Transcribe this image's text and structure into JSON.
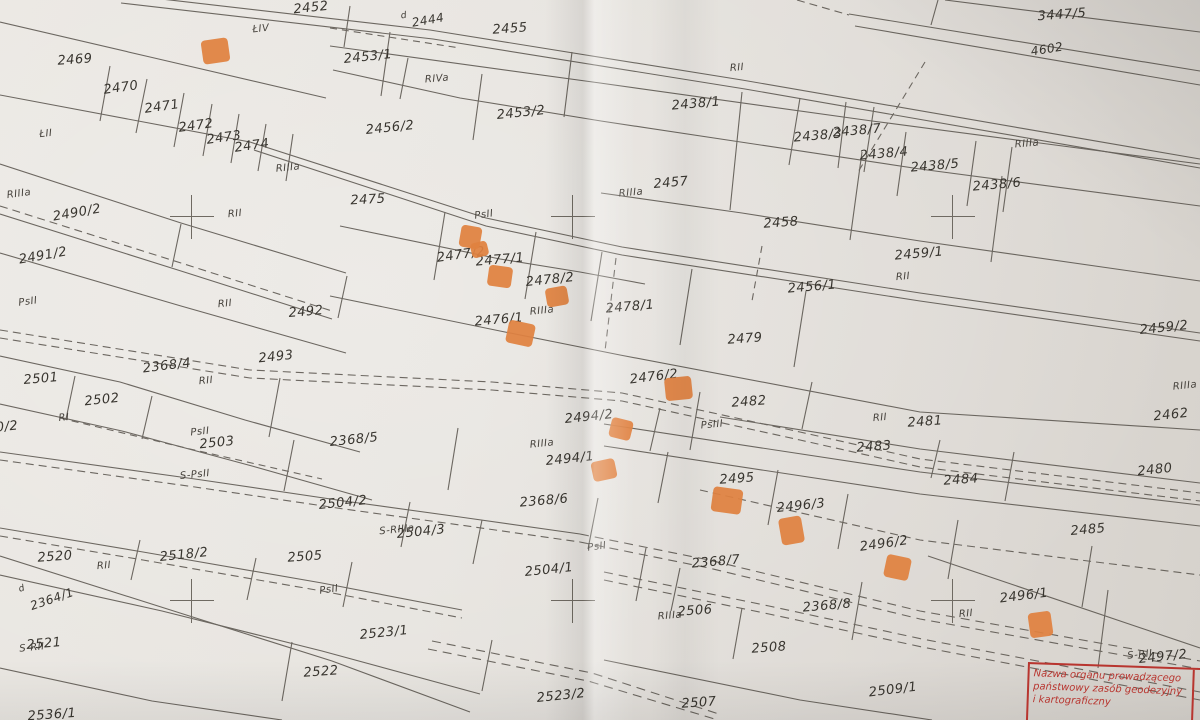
{
  "map": {
    "description": "cadastral parcel map sheet (photograph)",
    "paper_color": "#e6e3de",
    "line_color": "#5b564f",
    "marker_color": "#e0813f",
    "stamp": {
      "color": "#b8352f",
      "lines": [
        "Nazwa organu prowadzącego",
        "państwowy zasób geodezyjny",
        "i kartograficzny"
      ],
      "side_letter": "S"
    },
    "labels": [
      {
        "t": "2455",
        "x": 510,
        "y": 29,
        "r": -4,
        "k": "p"
      },
      {
        "t": "2452",
        "x": 311,
        "y": 8,
        "r": -6,
        "k": "p"
      },
      {
        "t": "2469",
        "x": 75,
        "y": 60,
        "r": -4,
        "k": "p"
      },
      {
        "t": "2470",
        "x": 121,
        "y": 88,
        "r": -8,
        "k": "p"
      },
      {
        "t": "2471",
        "x": 162,
        "y": 107,
        "r": -8,
        "k": "p"
      },
      {
        "t": "2472",
        "x": 196,
        "y": 126,
        "r": -8,
        "k": "p"
      },
      {
        "t": "2473",
        "x": 224,
        "y": 138,
        "r": -8,
        "k": "p"
      },
      {
        "t": "2474",
        "x": 252,
        "y": 146,
        "r": -8,
        "k": "p"
      },
      {
        "t": "2453/1",
        "x": 368,
        "y": 57,
        "r": -6,
        "k": "p"
      },
      {
        "t": "2453/2",
        "x": 521,
        "y": 113,
        "r": -6,
        "k": "p"
      },
      {
        "t": "2456/2",
        "x": 390,
        "y": 128,
        "r": -6,
        "k": "p"
      },
      {
        "t": "2438/1",
        "x": 696,
        "y": 104,
        "r": -5,
        "k": "p"
      },
      {
        "t": "2438/3",
        "x": 818,
        "y": 136,
        "r": -5,
        "k": "p"
      },
      {
        "t": "2438/7",
        "x": 857,
        "y": 131,
        "r": -5,
        "k": "p"
      },
      {
        "t": "2438/4",
        "x": 884,
        "y": 154,
        "r": -5,
        "k": "p"
      },
      {
        "t": "2438/5",
        "x": 935,
        "y": 166,
        "r": -5,
        "k": "p"
      },
      {
        "t": "2438/6",
        "x": 997,
        "y": 185,
        "r": -5,
        "k": "p"
      },
      {
        "t": "3447/5",
        "x": 1062,
        "y": 15,
        "r": -4,
        "k": "p"
      },
      {
        "t": "2457",
        "x": 671,
        "y": 183,
        "r": -5,
        "k": "p"
      },
      {
        "t": "2458",
        "x": 781,
        "y": 223,
        "r": -4,
        "k": "p"
      },
      {
        "t": "2456/1",
        "x": 812,
        "y": 287,
        "r": -5,
        "k": "p"
      },
      {
        "t": "2459/1",
        "x": 919,
        "y": 254,
        "r": -5,
        "k": "p"
      },
      {
        "t": "2459/2",
        "x": 1164,
        "y": 328,
        "r": -6,
        "k": "p"
      },
      {
        "t": "2475",
        "x": 368,
        "y": 200,
        "r": -3,
        "k": "p"
      },
      {
        "t": "2477/2",
        "x": 461,
        "y": 255,
        "r": -8,
        "k": "p"
      },
      {
        "t": "2477/1",
        "x": 500,
        "y": 260,
        "r": -5,
        "k": "p"
      },
      {
        "t": "2478/2",
        "x": 550,
        "y": 280,
        "r": -6,
        "k": "p"
      },
      {
        "t": "2478/1",
        "x": 630,
        "y": 307,
        "r": -5,
        "k": "p"
      },
      {
        "t": "2476/1",
        "x": 499,
        "y": 320,
        "r": -5,
        "k": "p"
      },
      {
        "t": "2479",
        "x": 745,
        "y": 339,
        "r": -4,
        "k": "p"
      },
      {
        "t": "2490/2",
        "x": 77,
        "y": 213,
        "r": -10,
        "k": "p"
      },
      {
        "t": "2491/2",
        "x": 43,
        "y": 256,
        "r": -10,
        "k": "p"
      },
      {
        "t": "2492",
        "x": 306,
        "y": 312,
        "r": -5,
        "k": "p"
      },
      {
        "t": "2493",
        "x": 276,
        "y": 357,
        "r": -6,
        "k": "p"
      },
      {
        "t": "2368/4",
        "x": 167,
        "y": 366,
        "r": -7,
        "k": "p"
      },
      {
        "t": "2501",
        "x": 41,
        "y": 379,
        "r": -5,
        "k": "p"
      },
      {
        "t": "2502",
        "x": 102,
        "y": 400,
        "r": -6,
        "k": "p"
      },
      {
        "t": "2503",
        "x": 217,
        "y": 443,
        "r": -6,
        "k": "p"
      },
      {
        "t": "2368/5",
        "x": 354,
        "y": 440,
        "r": -6,
        "k": "p"
      },
      {
        "t": "2504/2",
        "x": 343,
        "y": 503,
        "r": -6,
        "k": "p"
      },
      {
        "t": "2368/6",
        "x": 544,
        "y": 501,
        "r": -5,
        "k": "p"
      },
      {
        "t": "2494/2",
        "x": 589,
        "y": 417,
        "r": -6,
        "k": "p"
      },
      {
        "t": "2494/1",
        "x": 570,
        "y": 459,
        "r": -6,
        "k": "p"
      },
      {
        "t": "2476/2",
        "x": 654,
        "y": 377,
        "r": -7,
        "k": "p"
      },
      {
        "t": "2482",
        "x": 749,
        "y": 402,
        "r": -4,
        "k": "p"
      },
      {
        "t": "2483",
        "x": 874,
        "y": 447,
        "r": -4,
        "k": "p"
      },
      {
        "t": "2481",
        "x": 925,
        "y": 422,
        "r": -4,
        "k": "p"
      },
      {
        "t": "2462",
        "x": 1171,
        "y": 415,
        "r": -6,
        "k": "p"
      },
      {
        "t": "2484",
        "x": 961,
        "y": 480,
        "r": -4,
        "k": "p"
      },
      {
        "t": "2480",
        "x": 1155,
        "y": 470,
        "r": -6,
        "k": "p"
      },
      {
        "t": "2495",
        "x": 737,
        "y": 479,
        "r": -4,
        "k": "p"
      },
      {
        "t": "2496/3",
        "x": 801,
        "y": 506,
        "r": -6,
        "k": "p"
      },
      {
        "t": "2496/2",
        "x": 884,
        "y": 544,
        "r": -8,
        "k": "p"
      },
      {
        "t": "2368/7",
        "x": 716,
        "y": 562,
        "r": -5,
        "k": "p"
      },
      {
        "t": "2368/8",
        "x": 827,
        "y": 606,
        "r": -5,
        "k": "p"
      },
      {
        "t": "2506",
        "x": 695,
        "y": 611,
        "r": -4,
        "k": "p"
      },
      {
        "t": "2508",
        "x": 769,
        "y": 648,
        "r": -4,
        "k": "p"
      },
      {
        "t": "2509/1",
        "x": 893,
        "y": 690,
        "r": -7,
        "k": "p"
      },
      {
        "t": "2507",
        "x": 699,
        "y": 703,
        "r": -4,
        "k": "p"
      },
      {
        "t": "2485",
        "x": 1088,
        "y": 530,
        "r": -5,
        "k": "p"
      },
      {
        "t": "2496/1",
        "x": 1024,
        "y": 596,
        "r": -7,
        "k": "p"
      },
      {
        "t": "2497/2",
        "x": 1163,
        "y": 657,
        "r": -6,
        "k": "p"
      },
      {
        "t": "2520",
        "x": 55,
        "y": 557,
        "r": -4,
        "k": "p"
      },
      {
        "t": "2518/2",
        "x": 184,
        "y": 555,
        "r": -6,
        "k": "p"
      },
      {
        "t": "2505",
        "x": 305,
        "y": 557,
        "r": -4,
        "k": "p"
      },
      {
        "t": "2521",
        "x": 44,
        "y": 644,
        "r": -5,
        "k": "p"
      },
      {
        "t": "2522",
        "x": 321,
        "y": 672,
        "r": -4,
        "k": "p"
      },
      {
        "t": "2523/1",
        "x": 384,
        "y": 633,
        "r": -6,
        "k": "p"
      },
      {
        "t": "2523/2",
        "x": 561,
        "y": 696,
        "r": -6,
        "k": "p"
      },
      {
        "t": "2536/1",
        "x": 52,
        "y": 715,
        "r": -4,
        "k": "p"
      },
      {
        "t": "2504/3",
        "x": 421,
        "y": 532,
        "r": -6,
        "k": "p"
      },
      {
        "t": "2504/1",
        "x": 549,
        "y": 570,
        "r": -6,
        "k": "p"
      },
      {
        "t": "0/2",
        "x": 7,
        "y": 427,
        "r": -6,
        "k": "p"
      },
      {
        "t": "ŁIV",
        "x": 261,
        "y": 29,
        "r": -6,
        "k": "s"
      },
      {
        "t": "ŁII",
        "x": 46,
        "y": 134,
        "r": -6,
        "k": "s"
      },
      {
        "t": "RIIIa",
        "x": 288,
        "y": 168,
        "r": -6,
        "k": "s"
      },
      {
        "t": "RIVa",
        "x": 437,
        "y": 79,
        "r": -5,
        "k": "s"
      },
      {
        "t": "RII",
        "x": 737,
        "y": 68,
        "r": -5,
        "k": "s"
      },
      {
        "t": "RIIIa",
        "x": 1027,
        "y": 144,
        "r": -5,
        "k": "s"
      },
      {
        "t": "RIIIa",
        "x": 19,
        "y": 194,
        "r": -8,
        "k": "s"
      },
      {
        "t": "RII",
        "x": 235,
        "y": 214,
        "r": -6,
        "k": "s"
      },
      {
        "t": "RII",
        "x": 225,
        "y": 304,
        "r": -6,
        "k": "s"
      },
      {
        "t": "PsII",
        "x": 28,
        "y": 302,
        "r": -8,
        "k": "s"
      },
      {
        "t": "PsII",
        "x": 484,
        "y": 215,
        "r": -8,
        "k": "s"
      },
      {
        "t": "RIIIa",
        "x": 631,
        "y": 193,
        "r": -5,
        "k": "s"
      },
      {
        "t": "RII",
        "x": 903,
        "y": 277,
        "r": -5,
        "k": "s"
      },
      {
        "t": "RIIIa",
        "x": 542,
        "y": 311,
        "r": -6,
        "k": "s"
      },
      {
        "t": "RII",
        "x": 206,
        "y": 381,
        "r": -6,
        "k": "s"
      },
      {
        "t": "PsII",
        "x": 200,
        "y": 432,
        "r": -6,
        "k": "s"
      },
      {
        "t": "S-PsII",
        "x": 195,
        "y": 475,
        "r": -6,
        "k": "s"
      },
      {
        "t": "RI",
        "x": 64,
        "y": 418,
        "r": -6,
        "k": "s"
      },
      {
        "t": "RIIIa",
        "x": 542,
        "y": 444,
        "r": -6,
        "k": "s"
      },
      {
        "t": "PsIII",
        "x": 712,
        "y": 425,
        "r": -5,
        "k": "s"
      },
      {
        "t": "RII",
        "x": 880,
        "y": 418,
        "r": -5,
        "k": "s"
      },
      {
        "t": "RIIIa",
        "x": 1185,
        "y": 386,
        "r": -6,
        "k": "s"
      },
      {
        "t": "RII",
        "x": 104,
        "y": 566,
        "r": -5,
        "k": "s"
      },
      {
        "t": "S-RIIIa",
        "x": 397,
        "y": 530,
        "r": -6,
        "k": "s"
      },
      {
        "t": "PsII",
        "x": 329,
        "y": 590,
        "r": -8,
        "k": "s"
      },
      {
        "t": "PsII",
        "x": 597,
        "y": 547,
        "r": -8,
        "k": "s"
      },
      {
        "t": "RIIIa",
        "x": 670,
        "y": 616,
        "r": -5,
        "k": "s"
      },
      {
        "t": "RII",
        "x": 966,
        "y": 614,
        "r": -5,
        "k": "s"
      },
      {
        "t": "S-RII",
        "x": 1140,
        "y": 655,
        "r": -6,
        "k": "s"
      },
      {
        "t": "S-RII",
        "x": 32,
        "y": 648,
        "r": -6,
        "k": "s"
      },
      {
        "t": "d",
        "x": 22,
        "y": 589,
        "r": -18,
        "k": "d"
      },
      {
        "t": "d",
        "x": 404,
        "y": 16,
        "r": -10,
        "k": "d"
      },
      {
        "t": "2444",
        "x": 428,
        "y": 20,
        "r": -10,
        "k": "r"
      },
      {
        "t": "4602",
        "x": 1047,
        "y": 49,
        "r": -9,
        "k": "r"
      },
      {
        "t": "2364/1",
        "x": 52,
        "y": 599,
        "r": -19,
        "k": "r"
      }
    ],
    "markers": [
      {
        "x": 215,
        "y": 51,
        "w": 27,
        "h": 24,
        "r": -8
      },
      {
        "x": 470,
        "y": 237,
        "w": 21,
        "h": 22,
        "r": 10
      },
      {
        "x": 479,
        "y": 249,
        "w": 17,
        "h": 15,
        "r": -14
      },
      {
        "x": 500,
        "y": 276,
        "w": 24,
        "h": 21,
        "r": 8
      },
      {
        "x": 557,
        "y": 296,
        "w": 22,
        "h": 19,
        "r": -10
      },
      {
        "x": 520,
        "y": 333,
        "w": 27,
        "h": 23,
        "r": 12
      },
      {
        "x": 678,
        "y": 388,
        "w": 27,
        "h": 23,
        "r": -6
      },
      {
        "x": 621,
        "y": 429,
        "w": 22,
        "h": 20,
        "r": 14
      },
      {
        "x": 604,
        "y": 470,
        "w": 24,
        "h": 20,
        "r": -12
      },
      {
        "x": 727,
        "y": 500,
        "w": 30,
        "h": 25,
        "r": 8
      },
      {
        "x": 791,
        "y": 530,
        "w": 23,
        "h": 27,
        "r": -10
      },
      {
        "x": 897,
        "y": 567,
        "w": 25,
        "h": 23,
        "r": 12
      },
      {
        "x": 1040,
        "y": 624,
        "w": 23,
        "h": 25,
        "r": -8
      }
    ],
    "crosses": [
      {
        "x": 192,
        "y": 217
      },
      {
        "x": 573,
        "y": 217
      },
      {
        "x": 953,
        "y": 217
      },
      {
        "x": 192,
        "y": 601
      },
      {
        "x": 573,
        "y": 601
      },
      {
        "x": 953,
        "y": 601
      }
    ]
  }
}
